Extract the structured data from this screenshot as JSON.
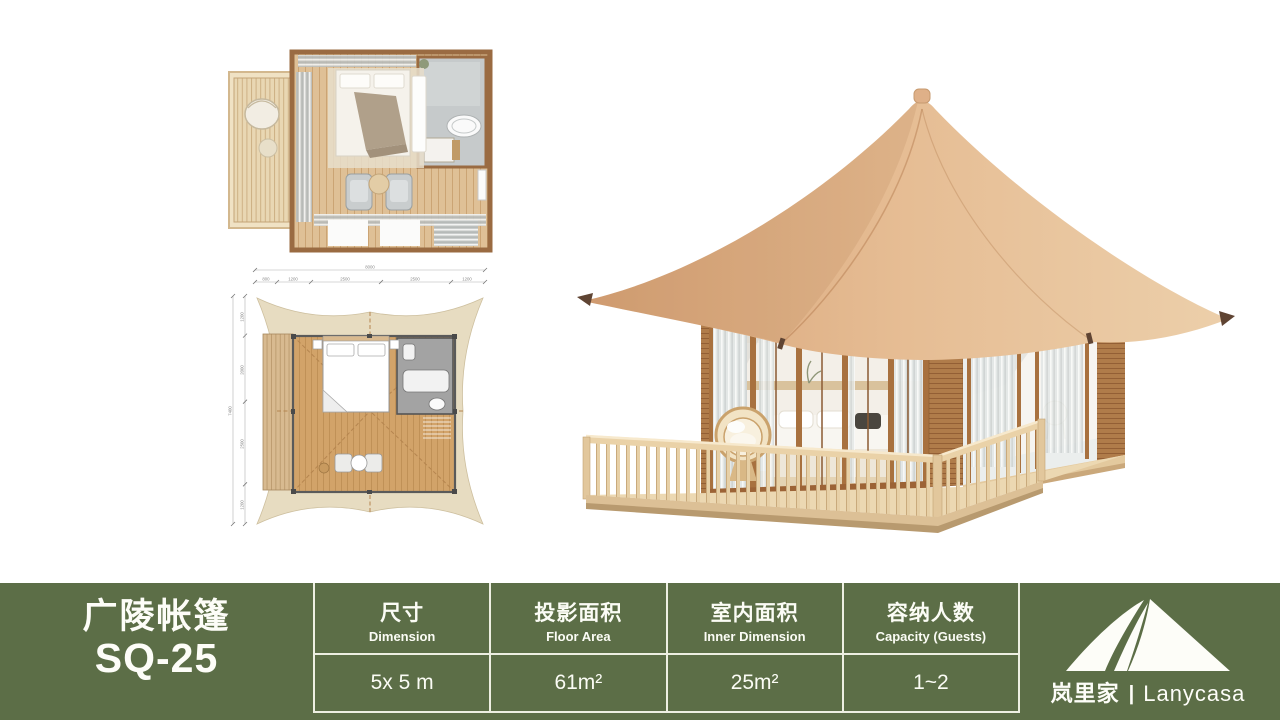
{
  "colors": {
    "accent_green": "#5C6E47",
    "table_divider": "#EDEFE2",
    "roof_tan": "#E4B58C",
    "wood_brown": "#A8713F",
    "deck_wood": "#E7D0A7",
    "canvas_beige": "#E7DCC1"
  },
  "product": {
    "name": "广陵帐篷",
    "model": "SQ-25"
  },
  "brand": {
    "name_zh": "岚里家",
    "separator": "|",
    "name_en": "Lanycasa"
  },
  "spec_table": {
    "columns": [
      {
        "header_zh": "尺寸",
        "header_en": "Dimension",
        "value": "5x 5 m"
      },
      {
        "header_zh": "投影面积",
        "header_en": "Floor Area",
        "value": "61m²"
      },
      {
        "header_zh": "室内面积",
        "header_en": "Inner Dimension",
        "value": "25m²"
      },
      {
        "header_zh": "容纳人数",
        "header_en": "Capacity (Guests)",
        "value": "1~2"
      }
    ]
  },
  "floor_plan": {
    "top_dims": {
      "total": "8000",
      "segments": [
        "800",
        "1200",
        "2500",
        "2500",
        "1200"
      ]
    },
    "left_dims": {
      "total": "7400",
      "segments": [
        "1200",
        "2000",
        "2500",
        "1200"
      ]
    }
  }
}
